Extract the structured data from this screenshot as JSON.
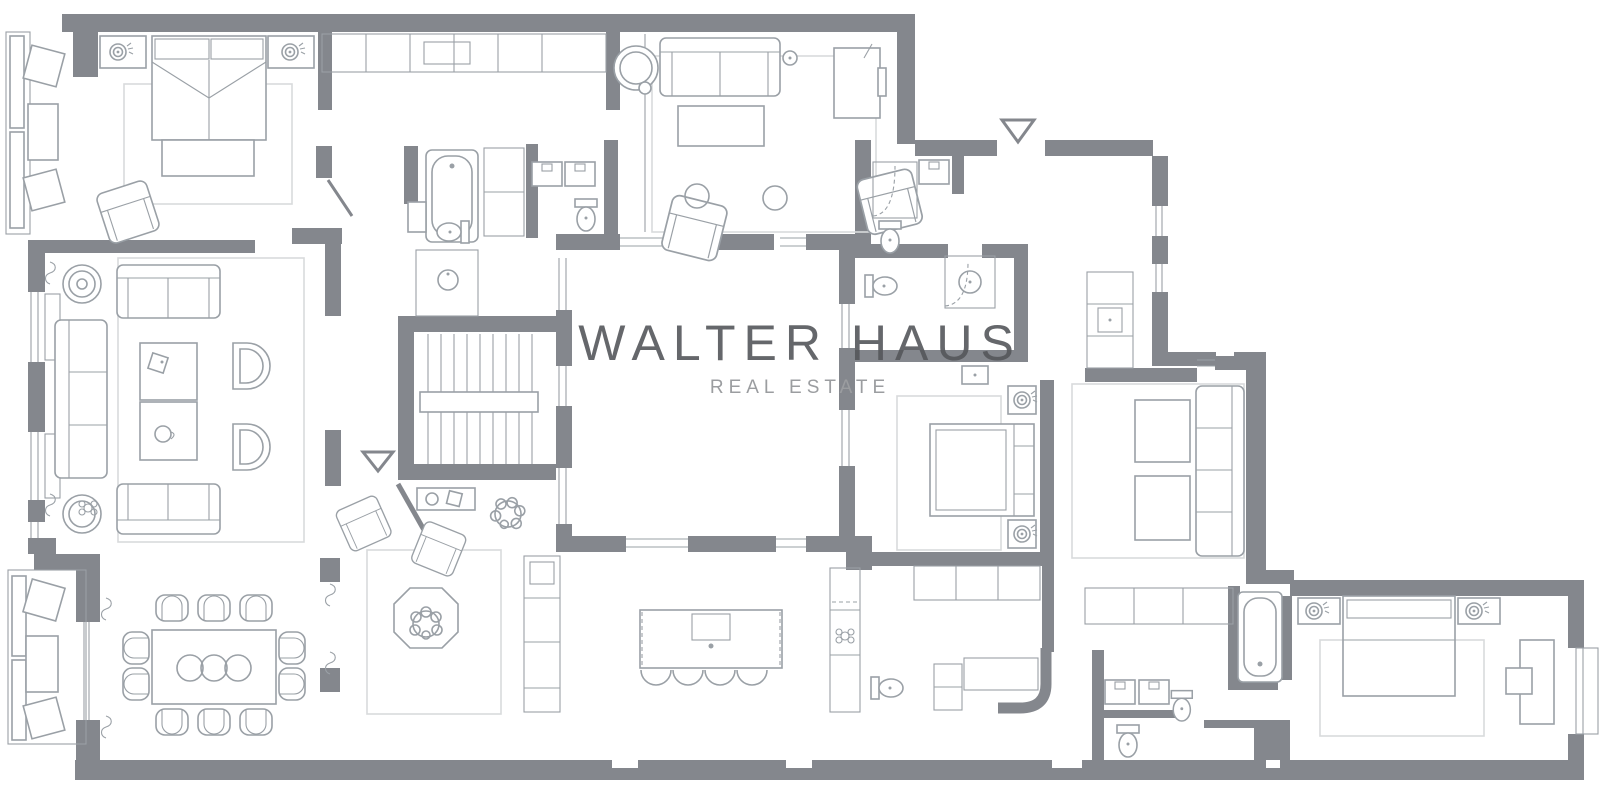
{
  "watermark": {
    "title": "WALTER HAUS",
    "subtitle": "REAL ESTATE"
  },
  "colors": {
    "background": "#FFFFFF",
    "wall": "#84878D",
    "furniture": "#9AA0A6",
    "rug": "#D8DADC",
    "watermark_title": "#55575B",
    "watermark_subtitle": "#9B9DA0"
  },
  "plan": {
    "type": "apartment-floor-plan",
    "entrance_markers": 2,
    "icons": [
      "double-bed-icon",
      "single-bed-icon",
      "sofa-icon",
      "armchair-icon",
      "dining-table-icon",
      "dining-chair-icon",
      "kitchen-island-icon",
      "bar-stool-icon",
      "bathtub-icon",
      "toilet-icon",
      "sink-icon",
      "shower-icon",
      "stairs-icon",
      "plant-icon",
      "rug-icon",
      "wardrobe-icon",
      "desk-icon",
      "coffee-table-icon",
      "window-bench-icon",
      "entrance-triangle-icon"
    ]
  }
}
